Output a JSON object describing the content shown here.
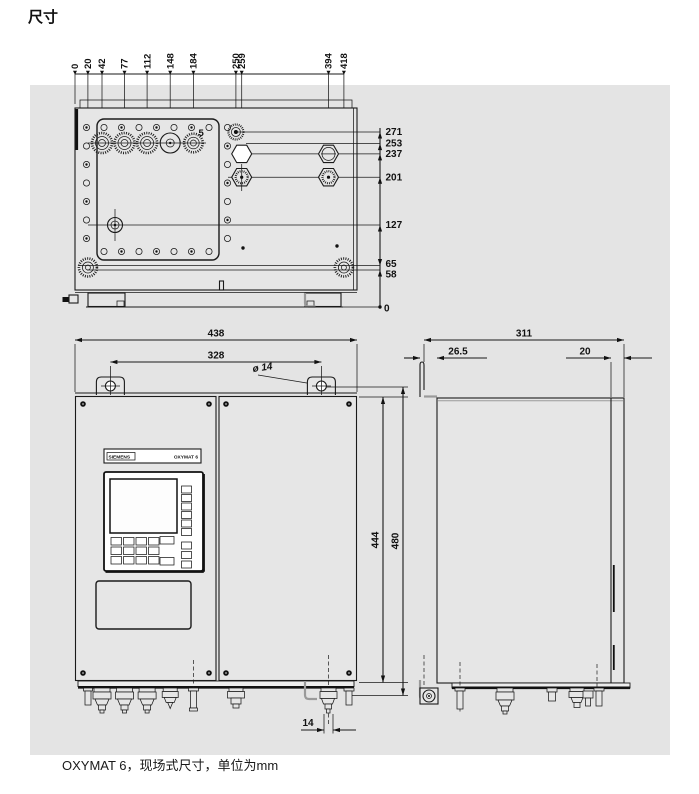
{
  "page": {
    "title": "尺寸",
    "caption": "OXYMAT 6，现场式尺寸，单位为mm"
  },
  "colors": {
    "panel": "#e4e4e4",
    "line": "#1a1a1a"
  },
  "top_view": {
    "scale_labels": [
      "0",
      "20",
      "42",
      "77",
      "112",
      "148",
      "184",
      "250",
      "259",
      "394",
      "418"
    ],
    "right_labels": [
      "271",
      "253",
      "237",
      "201",
      "127",
      "65",
      "58",
      "0"
    ],
    "item_label": "5"
  },
  "front_view": {
    "dim_width_outer": "438",
    "dim_width_mounting": "328",
    "dim_hole": "ø 14",
    "dim_height_inner": "444",
    "dim_height_outer": "480",
    "dim_gland": "14",
    "brand": "SIEMENS",
    "model": "OXYMAT 6"
  },
  "side_view": {
    "dim_depth": "311",
    "dim_bracket": "26.5",
    "dim_door": "20"
  }
}
